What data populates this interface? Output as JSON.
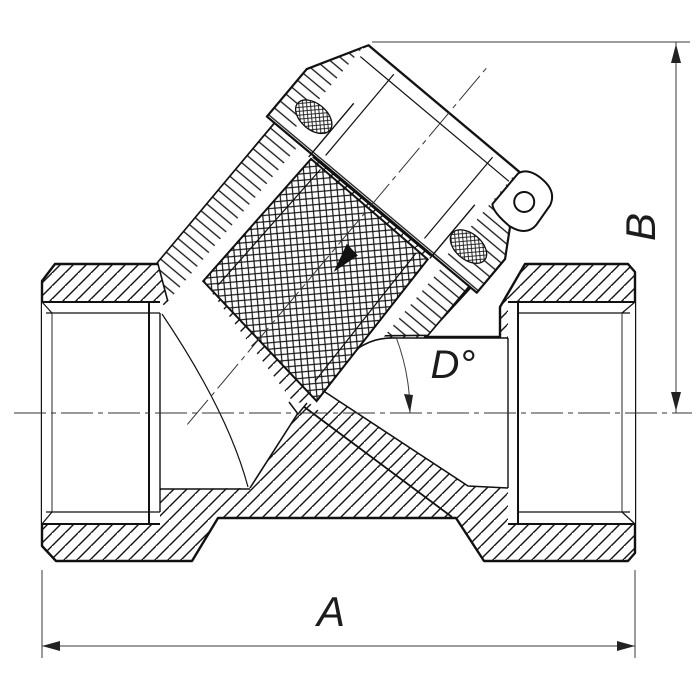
{
  "drawing": {
    "labels": {
      "width_dim": "A",
      "height_dim": "B",
      "angle_dim": "D°"
    },
    "colors": {
      "ink": "#111111",
      "dim_line": "#3a3a3a",
      "background": "#ffffff"
    }
  }
}
